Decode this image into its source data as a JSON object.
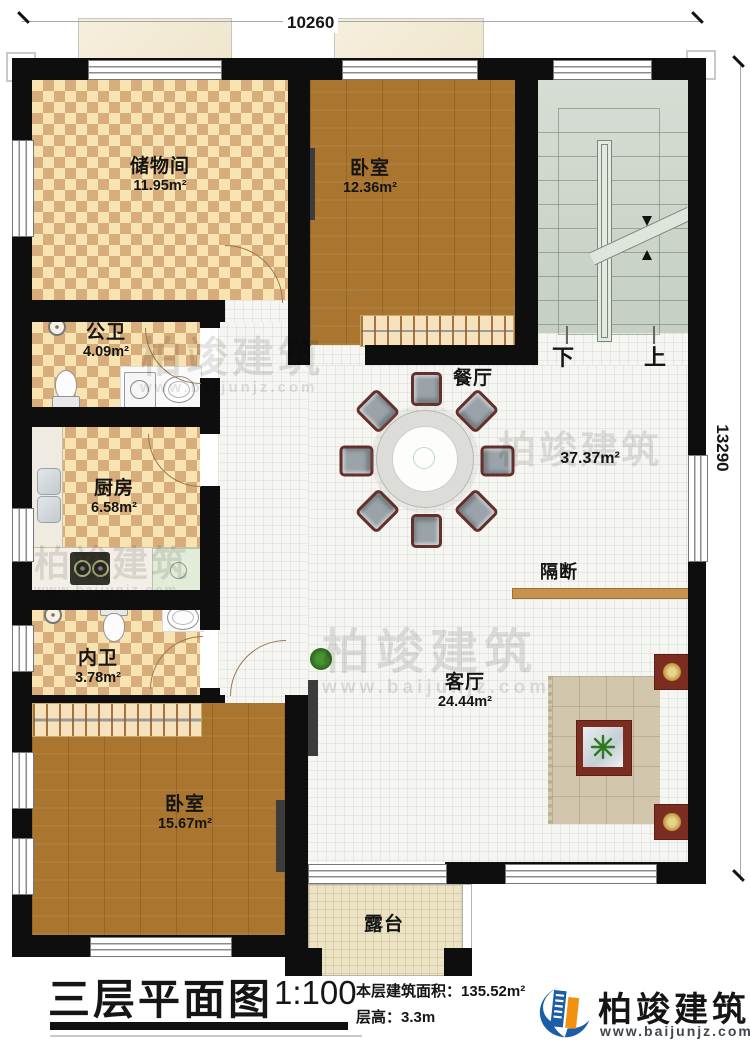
{
  "title_block": {
    "title": "三层平面图",
    "scale": "1:100",
    "area_label": "本层建筑面积：",
    "area_value": "135.52m²",
    "height_label": "层高：",
    "height_value": "3.3m"
  },
  "dimensions": {
    "width": "10260",
    "height": "13290"
  },
  "rooms": [
    {
      "name": "储物间",
      "area": "11.95m²"
    },
    {
      "name": "卧室",
      "area": "12.36m²"
    },
    {
      "name": "公卫",
      "area": "4.09m²"
    },
    {
      "name": "厨房",
      "area": "6.58m²"
    },
    {
      "name": "内卫",
      "area": "3.78m²"
    },
    {
      "name": "卧室",
      "area": "15.67m²"
    },
    {
      "name": "餐厅",
      "area": "37.37m²"
    },
    {
      "name": "客厅",
      "area": "24.44m²"
    },
    {
      "name": "露台"
    },
    {
      "name": "隔断"
    }
  ],
  "stairs": {
    "down": "下",
    "up": "上"
  },
  "watermark": {
    "brand": "柏竣建筑",
    "url": "www.baijunjz.com"
  },
  "logo": {
    "brand": "柏竣建筑",
    "url": "www.baijunjz.com"
  },
  "colors": {
    "wall": "#0e0e0e",
    "checker_light": "#f8e3b2",
    "checker_dark": "#d8ad7c",
    "wood": "#a9752f",
    "tile": "#f5f5f2",
    "stairs": "#cdd5c9",
    "terrace": "#ece3c5",
    "partition": "#c8914d",
    "logo_blue": "#1a5ea8",
    "logo_orange": "#f0920f"
  }
}
